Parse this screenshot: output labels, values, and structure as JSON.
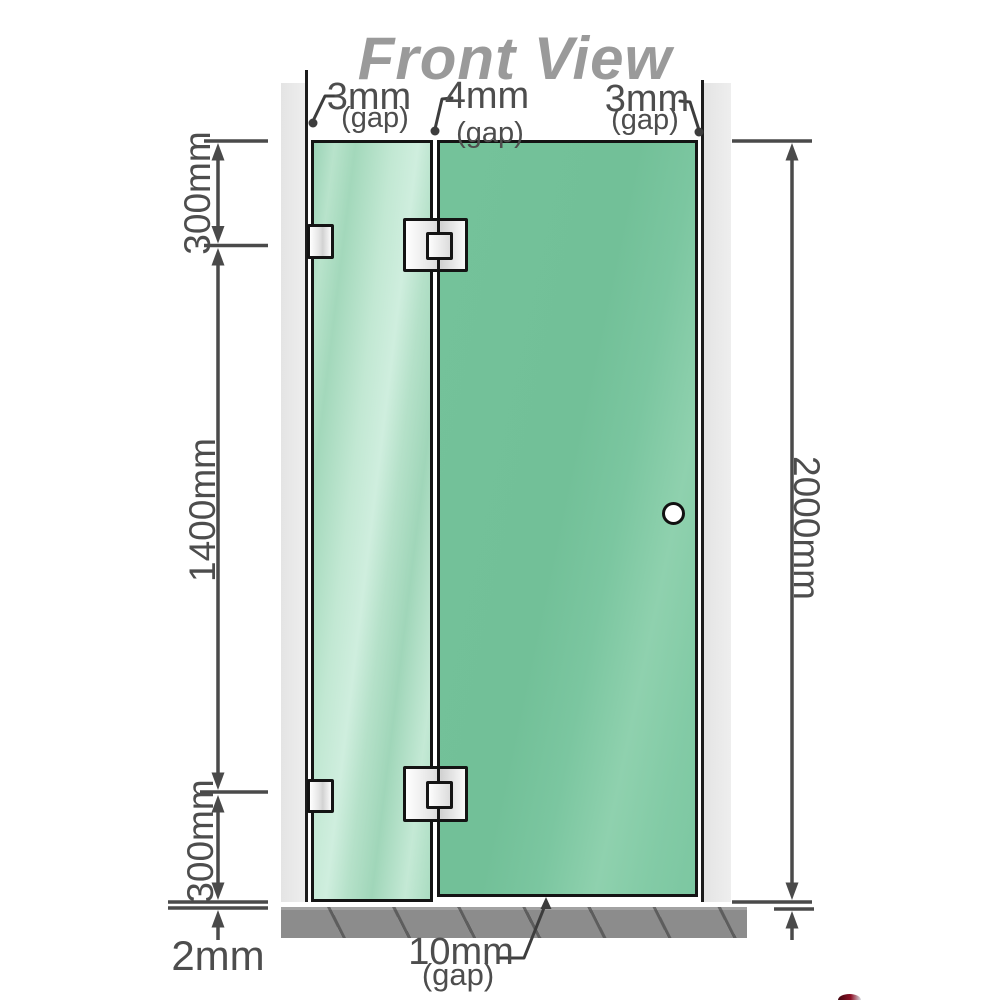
{
  "title": "Front View",
  "gap_labels": {
    "left": {
      "value": "3mm",
      "note": "(gap)"
    },
    "middle": {
      "value": "4mm",
      "note": "(gap)"
    },
    "right": {
      "value": "3mm",
      "note": "(gap)"
    },
    "bottom": {
      "value": "10mm",
      "note": "(gap)"
    }
  },
  "dimension_labels": {
    "left_top": "300mm",
    "left_middle": "1400mm",
    "left_bottom": "300mm",
    "right_full": "2000mm",
    "floor": "2mm"
  },
  "colors": {
    "glass_fixed_panel": "#aaddc2",
    "glass_door_panel": "#7cc7a1",
    "wall": "#e9e9e9",
    "wall_edge": "#1c1c1c",
    "floor_base": "#8c8c8c",
    "dimension_line": "#4a4a4a",
    "label_text": "#4d4d4d",
    "title_text": "#9a9a9a",
    "hardware_border": "#141414"
  }
}
